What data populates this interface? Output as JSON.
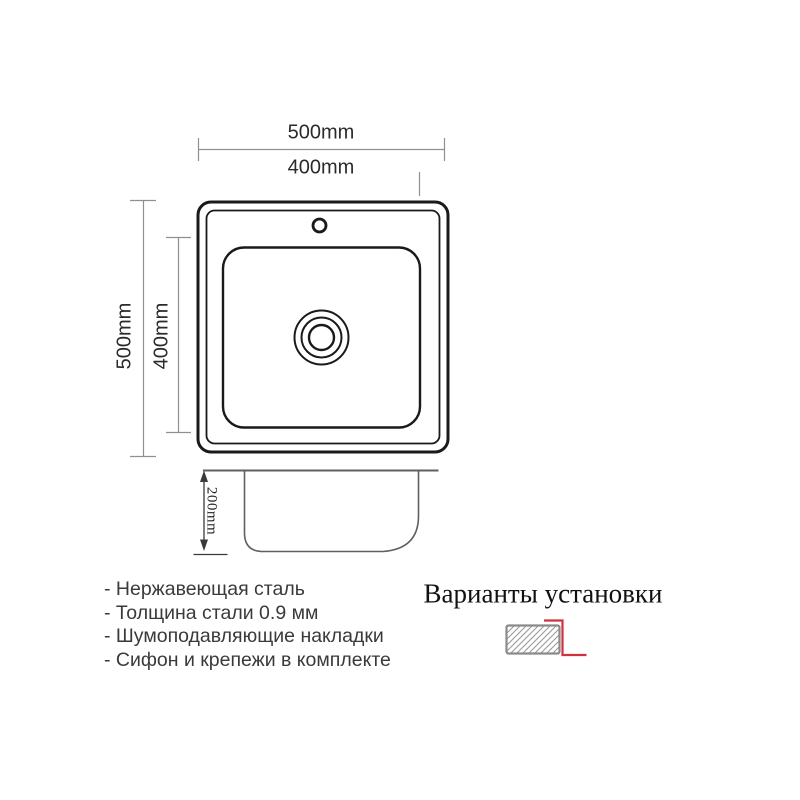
{
  "top_view": {
    "outer_width_label": "500mm",
    "inner_width_label": "400mm",
    "outer_height_label": "500mm",
    "inner_height_label": "400mm"
  },
  "side_view": {
    "depth_label": "200mm"
  },
  "features": [
    "- Нержавеющая сталь",
    "- Толщина стали 0.9 мм",
    "- Шумоподавляющие накладки",
    "- Сифон и крепежи в комплекте"
  ],
  "installation": {
    "title": "Варианты установки",
    "icon": "overmount-installation-icon"
  },
  "colors": {
    "outline_black": "#1a1a1a",
    "dimension_gray": "#909090",
    "side_view_gray": "#606060",
    "depth_dim_dark": "#3a3a3a",
    "accent_red": "#cf3140",
    "hatch_gray": "#9a9a9a",
    "icon_border_gray": "#8b8b8b"
  }
}
